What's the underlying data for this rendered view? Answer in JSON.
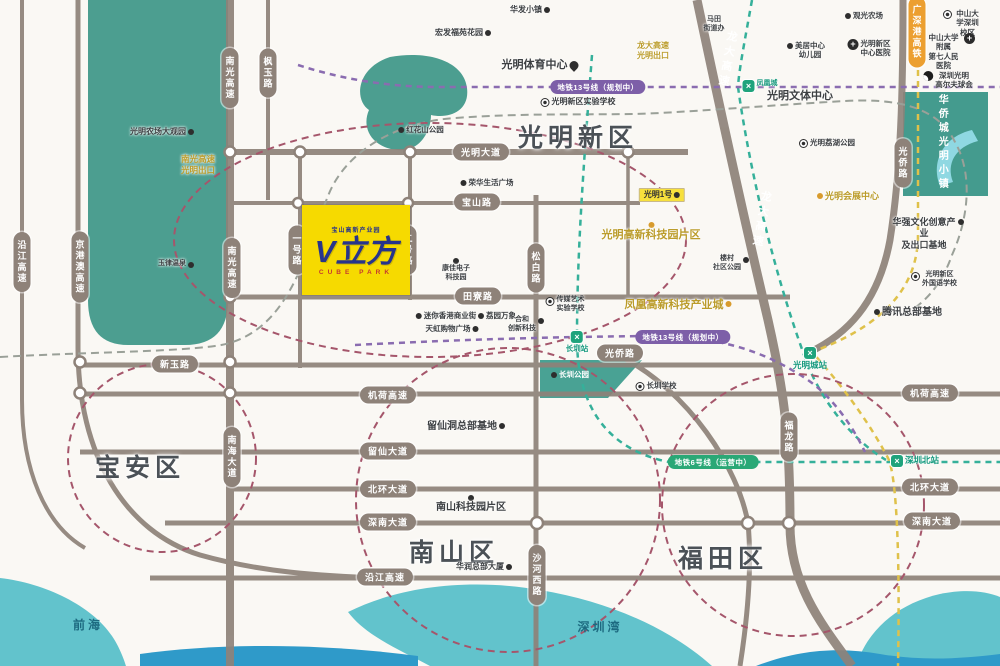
{
  "project": {
    "topline": "宝山高新产业园",
    "name": "V立方",
    "subline": "CUBE PARK"
  },
  "districts": [
    {
      "t": "光明新区",
      "x": 578,
      "y": 118
    },
    {
      "t": "宝安区",
      "x": 140,
      "y": 448
    },
    {
      "t": "南山区",
      "x": 454,
      "y": 533
    },
    {
      "t": "福田区",
      "x": 723,
      "y": 539
    }
  ],
  "ribbons": [
    {
      "t": "光明大道",
      "x": 481,
      "y": 152
    },
    {
      "t": "宝山路",
      "x": 477,
      "y": 202
    },
    {
      "t": "田寮路",
      "x": 478,
      "y": 296
    },
    {
      "t": "新玉路",
      "x": 175,
      "y": 364
    },
    {
      "t": "光侨路",
      "x": 620,
      "y": 353
    },
    {
      "t": "机荷高速",
      "x": 388,
      "y": 395
    },
    {
      "t": "留仙大道",
      "x": 388,
      "y": 451
    },
    {
      "t": "北环大道",
      "x": 388,
      "y": 489
    },
    {
      "t": "深南大道",
      "x": 388,
      "y": 522
    },
    {
      "t": "沿江高速",
      "x": 385,
      "y": 577
    },
    {
      "t": "机荷高速",
      "x": 930,
      "y": 393
    },
    {
      "t": "北环大道",
      "x": 930,
      "y": 487
    },
    {
      "t": "深南大道",
      "x": 932,
      "y": 521
    },
    {
      "t": "南光高速",
      "x": 230,
      "y": 78,
      "v": 1
    },
    {
      "t": "枫玉路",
      "x": 268,
      "y": 73,
      "v": 1
    },
    {
      "t": "南光高速",
      "x": 232,
      "y": 268,
      "v": 1
    },
    {
      "t": "京港澳高速",
      "x": 80,
      "y": 267,
      "v": 1
    },
    {
      "t": "沿江高速",
      "x": 22,
      "y": 262,
      "v": 1
    },
    {
      "t": "一号路",
      "x": 297,
      "y": 250,
      "v": 1
    },
    {
      "t": "二号路",
      "x": 408,
      "y": 250,
      "v": 1
    },
    {
      "t": "松白路",
      "x": 536,
      "y": 268,
      "v": 1
    },
    {
      "t": "南海大道",
      "x": 232,
      "y": 457,
      "v": 1
    },
    {
      "t": "沙河西路",
      "x": 537,
      "y": 575,
      "v": 1
    },
    {
      "t": "福龙路",
      "x": 789,
      "y": 437,
      "v": 1
    },
    {
      "t": "光侨路",
      "x": 903,
      "y": 163,
      "v": 1
    },
    {
      "t": "广深港高铁",
      "x": 917,
      "y": 32,
      "v": 1,
      "c": "o"
    }
  ],
  "onroad": [
    {
      "t": "龙大高速",
      "x": 727,
      "y": 60
    },
    {
      "t": "龙大高速",
      "x": 761,
      "y": 220
    }
  ],
  "mbadges": [
    {
      "t": "地铁13号线（规划中）",
      "x": 598,
      "y": 87,
      "c": "p"
    },
    {
      "t": "地铁13号线（规划中）",
      "x": 683,
      "y": 337,
      "c": "p"
    },
    {
      "t": "地铁6号线（运营中）",
      "x": 713,
      "y": 462,
      "c": "g"
    }
  ],
  "pois": [
    {
      "t": "光明农场大观园",
      "x": 162,
      "y": 127,
      "m": "dot",
      "ms": "r",
      "fs": 8
    },
    {
      "t": "华发小镇",
      "x": 530,
      "y": 5,
      "m": "dot",
      "ms": "r",
      "fs": 8
    },
    {
      "t": "宏发福苑花园",
      "x": 463,
      "y": 28,
      "m": "dot",
      "ms": "r",
      "fs": 8
    },
    {
      "t": "马田\n街道办",
      "x": 714,
      "y": 16,
      "fs": 7
    },
    {
      "t": "光明体育中心",
      "x": 540,
      "y": 59,
      "m": "pin",
      "ms": "r",
      "fs": 11
    },
    {
      "t": "光明新区实验学校",
      "x": 578,
      "y": 97,
      "m": "circ",
      "ms": "l",
      "fs": 8
    },
    {
      "t": "凤凰城",
      "x": 760,
      "y": 80,
      "m": "station",
      "ms": "l",
      "fs": 7,
      "cls": "grn"
    },
    {
      "t": "美居中心\n幼儿园",
      "x": 806,
      "y": 41,
      "m": "dot",
      "ms": "l",
      "fs": 7.5
    },
    {
      "t": "光明新区\n中心医院",
      "x": 869,
      "y": 39,
      "m": "cross",
      "ms": "l",
      "fs": 7.5
    },
    {
      "t": "观光农场",
      "x": 864,
      "y": 11,
      "m": "dot",
      "ms": "l",
      "fs": 7.5
    },
    {
      "t": "中山大学深圳校区",
      "x": 962,
      "y": 9,
      "m": "circ",
      "ms": "l",
      "fs": 7.5
    },
    {
      "t": "中山大学附属\n第七人民医院",
      "x": 950,
      "y": 33,
      "m": "cross",
      "ms": "r",
      "fs": 7.5
    },
    {
      "t": "深圳光明\n高尔夫球会",
      "x": 948,
      "y": 71,
      "m": "golf",
      "ms": "l",
      "fs": 7.5
    },
    {
      "t": "光明文体中心",
      "x": 800,
      "y": 90,
      "fs": 11
    },
    {
      "t": "光明荔湖公园",
      "x": 827,
      "y": 138,
      "m": "circ",
      "ms": "l",
      "fs": 7.5
    },
    {
      "t": "光明会展中心",
      "x": 848,
      "y": 191,
      "m": "odot",
      "ms": "l",
      "fs": 9,
      "cls": "gold"
    },
    {
      "t": "龙大高速\n光明出口",
      "x": 653,
      "y": 41,
      "cls": "gold",
      "fs": 8
    },
    {
      "t": "南光高速\n光明出口",
      "x": 198,
      "y": 154,
      "cls": "gold",
      "fs": 8.5
    },
    {
      "t": "光明高新科技园片区",
      "x": 651,
      "y": 220,
      "m": "odot",
      "ms": "t",
      "fs": 11,
      "cls": "gold"
    },
    {
      "t": "凤凰高新科技产业城",
      "x": 678,
      "y": 299,
      "m": "odot",
      "ms": "r",
      "fs": 11,
      "cls": "gold"
    },
    {
      "t": "华强文化创意产业\n及出口基地",
      "x": 928,
      "y": 217,
      "m": "dot",
      "ms": "r",
      "fs": 9
    },
    {
      "t": "光明新区\n外国语学校",
      "x": 934,
      "y": 271,
      "m": "circ",
      "ms": "l",
      "fs": 7
    },
    {
      "t": "腾讯总部基地",
      "x": 908,
      "y": 307,
      "m": "dot",
      "ms": "l",
      "fs": 10
    },
    {
      "t": "华侨城光明小镇",
      "x": 941,
      "y": 143,
      "cls": "vert wt",
      "fs": 10
    },
    {
      "t": "玉律温泉",
      "x": 176,
      "y": 260,
      "m": "dot",
      "ms": "r",
      "fs": 7
    },
    {
      "t": "红花山公园",
      "x": 421,
      "y": 125,
      "m": "dot",
      "ms": "l",
      "fs": 7.5
    },
    {
      "t": "荣华生活广场",
      "x": 487,
      "y": 178,
      "m": "dot",
      "ms": "l",
      "fs": 7.5
    },
    {
      "t": "康佳电子\n科技园",
      "x": 456,
      "y": 256,
      "m": "dot",
      "ms": "t",
      "fs": 7
    },
    {
      "t": "迷你香港商业街",
      "x": 446,
      "y": 311,
      "m": "dot",
      "ms": "l",
      "fs": 7.5
    },
    {
      "t": "荔园万象",
      "x": 497,
      "y": 311,
      "m": "dot",
      "ms": "l",
      "fs": 7.5
    },
    {
      "t": "天虹购物广场",
      "x": 452,
      "y": 324,
      "m": "dot",
      "ms": "r",
      "fs": 7.5
    },
    {
      "t": "合和\n创新科技",
      "x": 526,
      "y": 316,
      "m": "dot",
      "ms": "r",
      "fs": 7
    },
    {
      "t": "传媒艺术\n实验学校",
      "x": 565,
      "y": 296,
      "m": "circ",
      "ms": "l",
      "fs": 7
    },
    {
      "t": "楼村\n社区公园",
      "x": 731,
      "y": 255,
      "m": "dot",
      "ms": "r",
      "fs": 7
    },
    {
      "t": "长圳公园",
      "x": 570,
      "y": 370,
      "m": "dot",
      "ms": "l",
      "fs": 7.5,
      "cls": "wt"
    },
    {
      "t": "长圳学校",
      "x": 656,
      "y": 381,
      "m": "circ",
      "ms": "l",
      "fs": 7.5
    },
    {
      "t": "长圳站",
      "x": 577,
      "y": 331,
      "m": "station",
      "ms": "t",
      "fs": 7.5,
      "cls": "grn"
    },
    {
      "t": "光明城站",
      "x": 810,
      "y": 347,
      "m": "station",
      "ms": "t",
      "fs": 8.5,
      "cls": "grn"
    },
    {
      "t": "深圳北站",
      "x": 915,
      "y": 455,
      "m": "station",
      "ms": "l",
      "fs": 8.5,
      "cls": "grn"
    },
    {
      "t": "留仙洞总部基地",
      "x": 466,
      "y": 421,
      "m": "dot",
      "ms": "r",
      "fs": 10
    },
    {
      "t": "南山科技园片区",
      "x": 471,
      "y": 493,
      "m": "dot",
      "ms": "t",
      "fs": 10
    },
    {
      "t": "华润总部大厦",
      "x": 484,
      "y": 562,
      "m": "dot",
      "ms": "r",
      "fs": 8
    },
    {
      "t": "前海",
      "x": 88,
      "y": 618,
      "fs": 12,
      "cls": "water"
    },
    {
      "t": "深圳湾",
      "x": 600,
      "y": 620,
      "fs": 12,
      "cls": "water"
    },
    {
      "t": "光明1号",
      "x": 662,
      "y": 188,
      "m": "dot",
      "ms": "r",
      "fs": 8,
      "cls": "chip"
    }
  ],
  "colors": {
    "green_block": "#4c9e90",
    "water": "#62c3cc",
    "deep_water": "#2f9ac9",
    "road": "#8e8279",
    "metro_green": "#35b09a",
    "metro_purple": "#8a6cb0",
    "hsr_yellow": "#dfc14a",
    "ring_red": "#a5566b",
    "project_yellow": "#f6da00",
    "logo_blue": "#27348b"
  }
}
